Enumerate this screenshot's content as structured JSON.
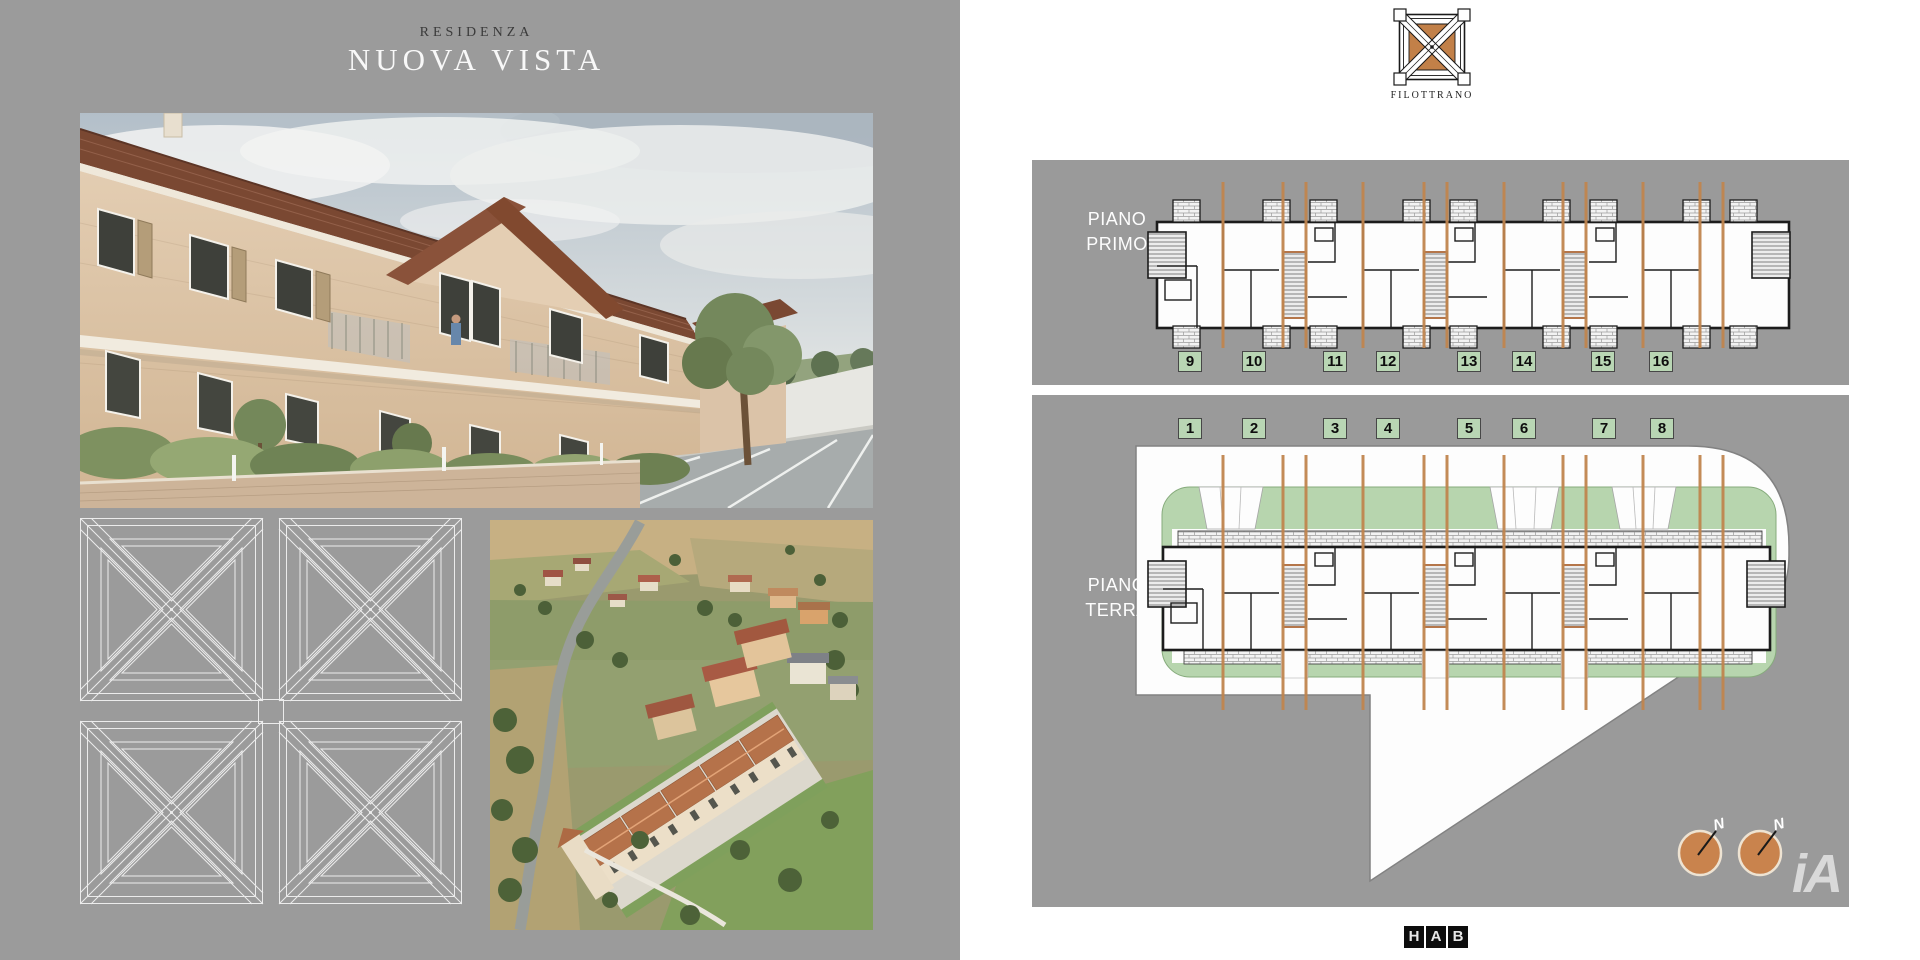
{
  "left": {
    "subtitle": "RESIDENZA",
    "title": "NUOVA VISTA",
    "figures": {
      "main_render": "exterior-street-render",
      "pattern": "coffered-ceiling-line-drawing",
      "aerial": "aerial-site-render"
    }
  },
  "right": {
    "logo_label": "FILOTTRANO",
    "floor_primo": {
      "line1": "PIANO",
      "line2": "PRIMO",
      "units": [
        "9",
        "10",
        "11",
        "12",
        "13",
        "14",
        "15",
        "16"
      ]
    },
    "floor_terra": {
      "line1": "PIANO",
      "line2": "TERRA",
      "units": [
        "1",
        "2",
        "3",
        "4",
        "5",
        "6",
        "7",
        "8"
      ]
    },
    "compass_label": "N",
    "brand_letters": [
      "H",
      "A",
      "B"
    ],
    "watermark": "iA"
  },
  "colors": {
    "background_left": "#9b9b9b",
    "panel_gray": "#9a9a9a",
    "terracotta_line": "#c0854f",
    "logo_terracotta": "#c28048",
    "unit_badge_green": "#b9d6b4",
    "garden_green": "#b7d5ae",
    "roof_terracotta": "#7a4832"
  }
}
